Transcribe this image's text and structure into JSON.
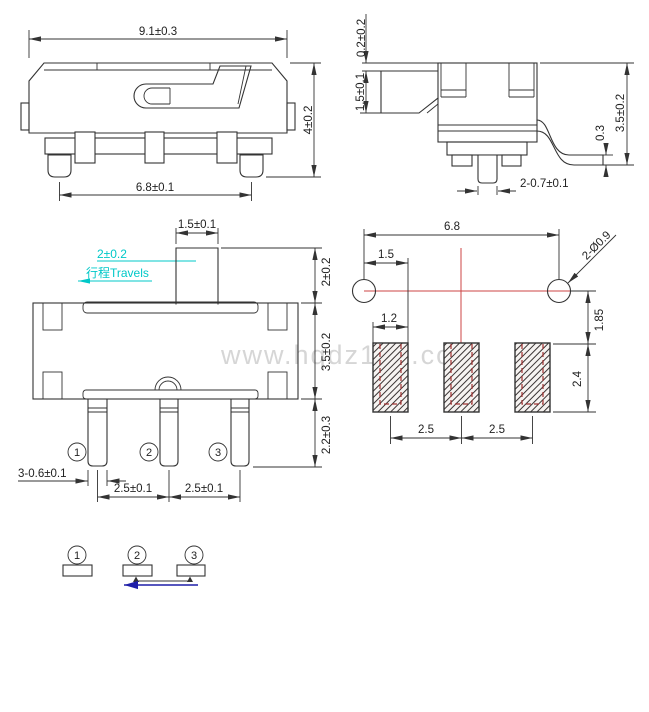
{
  "title": "slide switch dimensional drawing",
  "watermark": "www.hqdz123.com",
  "colors": {
    "line": "#333333",
    "accent_cyan": "#00c8c8",
    "centerline_red": "#cc4444",
    "pad_inner_red": "#a03030",
    "arrow_blue": "#1f1fa8",
    "watermark_gray": "#d6d6d6"
  },
  "side_view": {
    "dim_body_width": "9.1±0.3",
    "dim_body_height": "4±0.2",
    "dim_feet_span": "6.8±0.1"
  },
  "end_view": {
    "dim_cover_gap": "0.2±0.2",
    "dim_knob_height": "1.5±0.1",
    "dim_overall_height": "3.5±0.2",
    "dim_foot_thickness": "0.3",
    "dim_pin_width": "2-0.7±0.1"
  },
  "front_view": {
    "dim_knob_width": "1.5±0.1",
    "travel_dim": "2±0.2",
    "travel_label": "行程Travels",
    "dim_knob_height": "2±0.2",
    "dim_body_height": "3.5±0.2",
    "dim_pin_length": "2.2±0.3",
    "dim_pin_width": "3-0.6±0.1",
    "dim_pin_pitch_left": "2.5±0.1",
    "dim_pin_pitch_right": "2.5±0.1",
    "pin_numbers": [
      "1",
      "2",
      "3"
    ]
  },
  "pcb_view": {
    "dim_hole_span": "6.8",
    "dim_hole_to_pad": "1.5",
    "dim_pad_width": "1.2",
    "dim_hole_size": "2-Ø0.9",
    "dim_hole_to_pad_vert": "1.85",
    "dim_pad_height": "2.4",
    "dim_pad_pitch_left": "2.5",
    "dim_pad_pitch_right": "2.5"
  },
  "schematic_view": {
    "pin_numbers": [
      "1",
      "2",
      "3"
    ]
  }
}
